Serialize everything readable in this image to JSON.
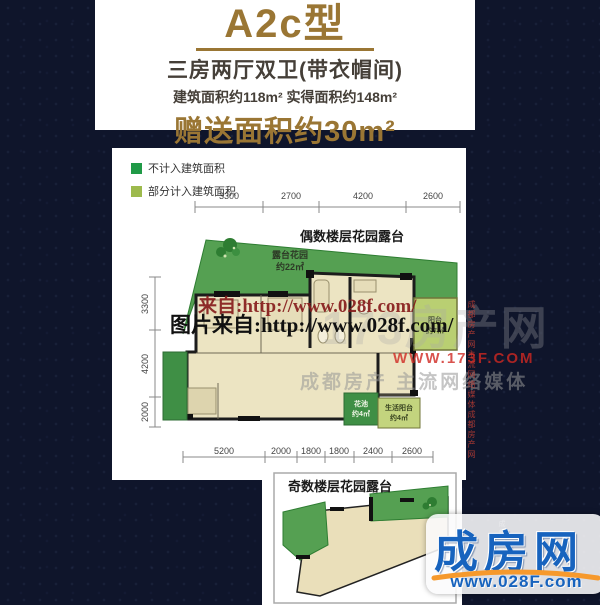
{
  "header": {
    "title": "A2c型",
    "subtitle": "三房两厅双卫(带衣帽间)",
    "area_line": "建筑面积约118m² 实得面积约148m²",
    "bonus_line": "赠送面积约30m²"
  },
  "legend": {
    "items": [
      {
        "label": "不计入建筑面积",
        "color": "#209a47"
      },
      {
        "label": "部分计入建筑面积",
        "color": "#9dba4d"
      }
    ]
  },
  "plan": {
    "even_label": "偶数楼层花园露台",
    "terrace_name": "露台花园",
    "terrace_area": "约22㎡",
    "balcony_name": "阳台",
    "balcony_area": "约7㎡",
    "flower_name": "花池",
    "flower_area": "约4㎡",
    "life_name": "生活阳台",
    "life_area": "约4㎡",
    "dims_top": [
      "3300",
      "2700",
      "4200",
      "2600"
    ],
    "dims_left": [
      "3300",
      "4200",
      "2000"
    ],
    "dims_bottom": [
      "5200",
      "2000",
      "1800",
      "1800",
      "2400",
      "2600"
    ]
  },
  "odd_plan": {
    "label": "奇数楼层花园露台"
  },
  "watermarks": {
    "line1": "来自:http://www.028f.com/",
    "line2": "图片来自:http://www.028f.com/",
    "ghost": "173房产网",
    "site": "WWW.173F.COM",
    "media": "成都房产 主流网络媒体",
    "vertical_right": "成都房产网主流网络媒体成都房产网",
    "vertical_logo": "成都房产网络媒体"
  },
  "logo": {
    "name": "成房网",
    "url": "www.028F.com"
  },
  "colors": {
    "gold": "#9a7634",
    "navy": "#0f152b",
    "legend_dark_green": "#209a47",
    "legend_light_green": "#9dba4d",
    "terrace_green": "#55a052",
    "floor_beige": "#ece4c2",
    "brand_blue": "#1763be",
    "swoosh_orange": "#f6992c"
  }
}
